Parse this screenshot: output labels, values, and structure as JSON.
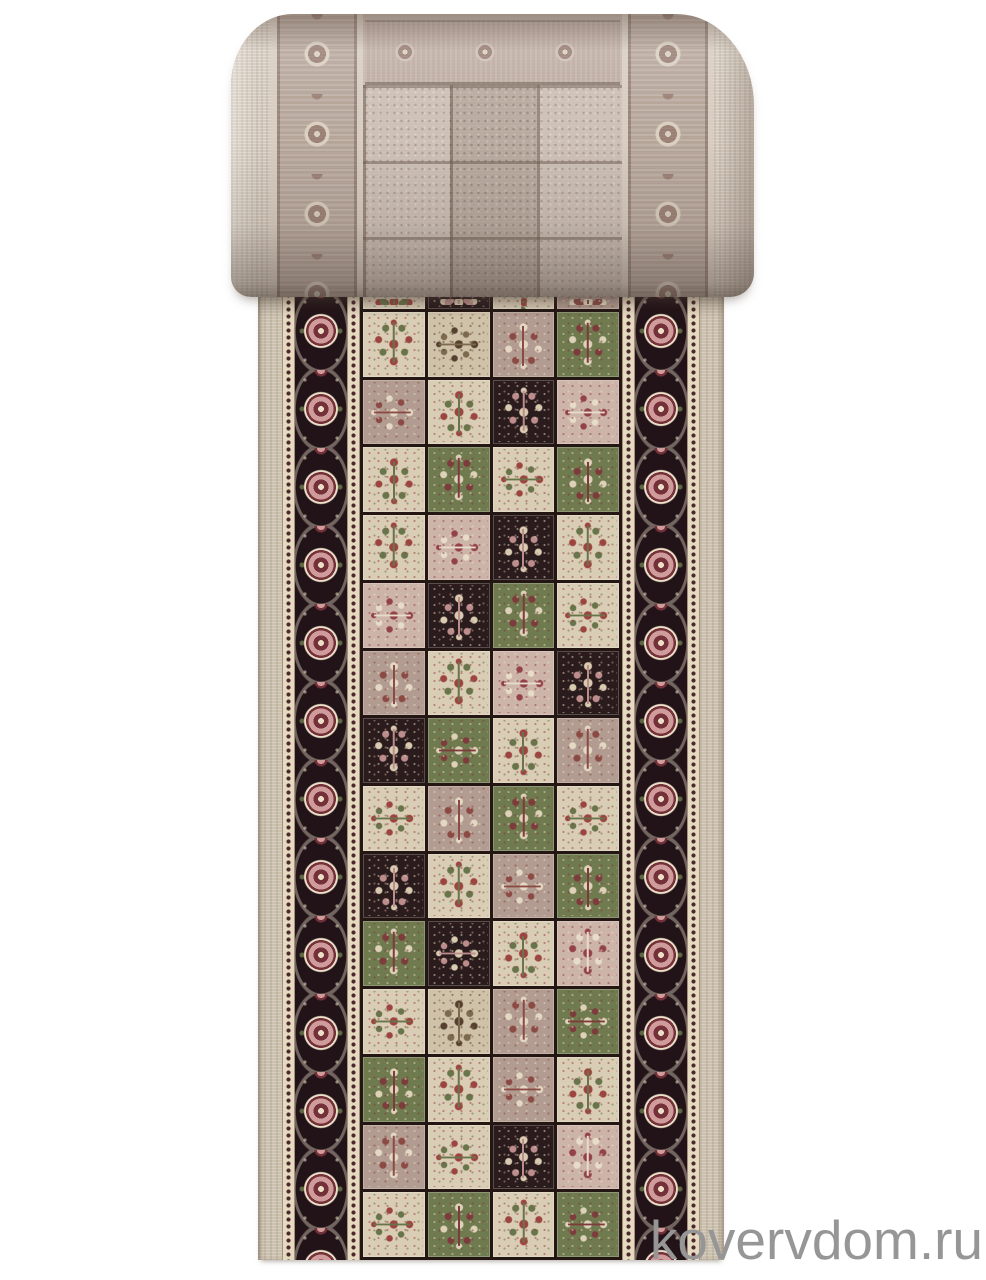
{
  "watermark": {
    "text": "kovervdom.ru"
  },
  "theme": {
    "page-bg": "#ffffff",
    "watermark": "#969696",
    "roll-base": "#c6b8ad",
    "roll-selvage": "#d4cabd",
    "roll-border-bg": "#b5a498",
    "roll-motif": "#9a8175",
    "roll-motif-light": "#dacfc1",
    "roll-guard": "#d8cdbf",
    "runner-selvage": "#ccc1af",
    "guard-bg": "#e5d9c0",
    "guard-dot": "#4c282c",
    "border-bg": "#221318",
    "rosette-pink": "#cf9b9b",
    "rosette-ring": "#743139",
    "rosette-center": "#ecdfc8",
    "leaf-green": "#5c6741",
    "grid-line": "#241713"
  },
  "runner": {
    "palettes": {
      "cream": {
        "bg": "#d9cdb6",
        "m1": "#9e4440",
        "m2": "#68744a"
      },
      "beige": {
        "bg": "#cfc2a8",
        "m1": "#57402f",
        "m2": "#7d6a4e"
      },
      "black": {
        "bg": "#2a1b1c",
        "m1": "#d8cbb0",
        "m2": "#bd8d8d"
      },
      "green": {
        "bg": "#6f7a4f",
        "m1": "#ddd2b8",
        "m2": "#7e3b3c"
      },
      "mauve": {
        "bg": "#b29b90",
        "m1": "#e3d8c4",
        "m2": "#8c4a44"
      },
      "pink": {
        "bg": "#cdb4a9",
        "m1": "#94424a",
        "m2": "#e6dcc8"
      }
    },
    "tile_rows": [
      [
        "cream",
        "black",
        "cream",
        "mauve"
      ],
      [
        "cream",
        "beige",
        "mauve",
        "green"
      ],
      [
        "mauve",
        "cream",
        "black",
        "pink"
      ],
      [
        "cream",
        "green",
        "cream",
        "green"
      ],
      [
        "cream",
        "pink",
        "black",
        "cream"
      ],
      [
        "pink",
        "black",
        "green",
        "cream"
      ],
      [
        "mauve",
        "cream",
        "pink",
        "black"
      ],
      [
        "black",
        "green",
        "cream",
        "mauve"
      ],
      [
        "cream",
        "mauve",
        "green",
        "cream"
      ],
      [
        "black",
        "cream",
        "mauve",
        "green"
      ],
      [
        "green",
        "black",
        "cream",
        "pink"
      ],
      [
        "cream",
        "beige",
        "mauve",
        "green"
      ],
      [
        "green",
        "cream",
        "mauve",
        "cream"
      ],
      [
        "mauve",
        "cream",
        "black",
        "pink"
      ],
      [
        "cream",
        "green",
        "cream",
        "green"
      ]
    ]
  }
}
